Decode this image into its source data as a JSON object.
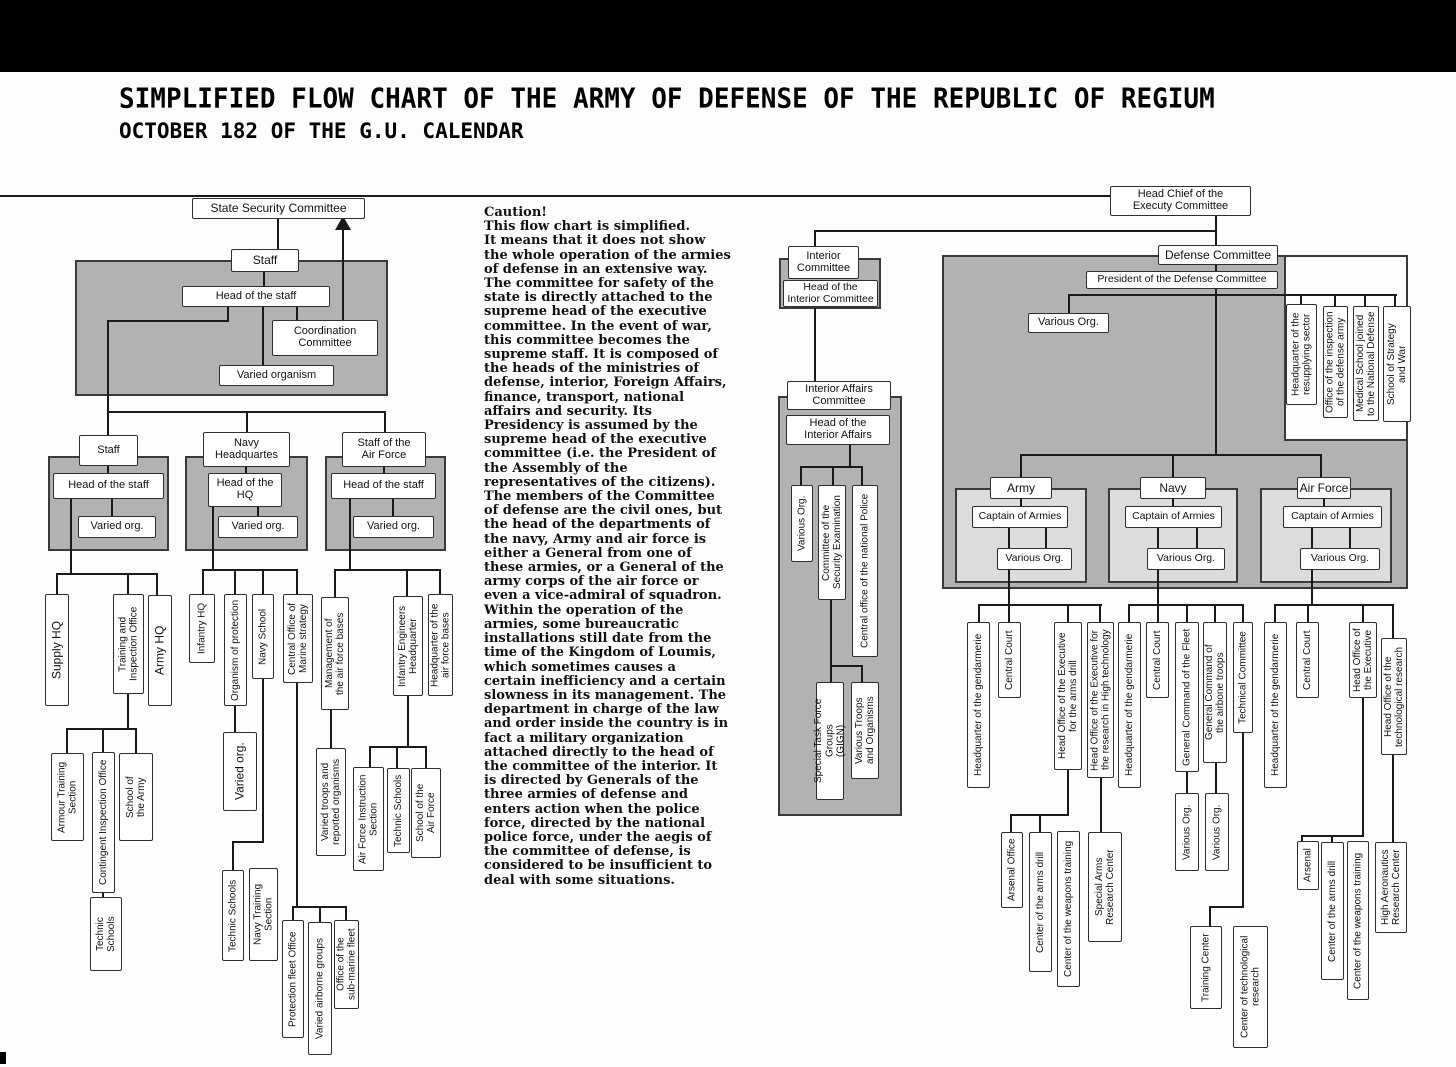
{
  "header": {
    "title": "SIMPLIFIED FLOW CHART OF THE ARMY OF DEFENSE OF THE REPUBLIC OF REGIUM",
    "subtitle": "OCTOBER 182 OF THE G.U. CALENDAR"
  },
  "caution": {
    "heading": "Caution!",
    "body": " This flow chart is simplified.\nIt means that it does not show the whole operation of the armies of defense in an extensive way.\nThe committee for safety of the state is directly attached to the supreme head of the executive committee. In the event of war, this committee becomes the supreme staff. It is composed of the heads of the ministries of defense, interior, Foreign Affairs, finance, transport, national affairs and security. Its Presidency is assumed by the supreme head of the executive committee (i.e. the President of the Assembly of the representatives of the citizens).\n The members of the Committee of defense are the civil ones, but the head of the departments of the navy, Army and air force is either a General from one of these armies, or a General of the army corps of the air force or even a vice-admiral of squadron.\nWithin the operation of the armies, some bureaucratic installations still date from the time of the Kingdom of Loumis, which sometimes causes a certain inefficiency and a certain slowness in its management. The department in charge of the law and order inside the country is in fact a military organization attached directly to the head of the committee of the interior. It is directed by Generals of the three armies of defense and enters action when the police force, directed by the national police force, under the aegis of the committee of defense, is considered to be insufficient to deal with some situations."
  },
  "colors": {
    "panel_gray": "#b2b2b2",
    "panel_light": "#dcdcdc",
    "line_black": "#1a1a1a",
    "box_white": "#ffffff"
  },
  "nodes": {
    "ssc": "State Security Committee",
    "staff_main": "Staff",
    "head_staff_main": "Head of the staff",
    "coordination": "Coordination\nCommittee",
    "varied_organism": "Varied organism",
    "staff_left": "Staff",
    "head_staff_left": "Head of the staff",
    "varied_left": "Varied org.",
    "navy_hq": "Navy\nHeadquartes",
    "head_hq": "Head of the\nHQ",
    "varied_mid": "Varied org.",
    "staff_af": "Staff of the\nAir Force",
    "head_staff_af": "Head of the staff",
    "varied_af": "Varied org.",
    "supply_hq": "Supply HQ",
    "training_inspection": "Training and\nInspection Office",
    "army_hq": "Army HQ",
    "armour_training": "Armour Training\nSection",
    "contingent_inspection": "Contingent Inspection Office",
    "school_army": "School of\nthe Army",
    "technic_schools_1": "Technic\nSchools",
    "infantry_hq": "Infantry HQ",
    "organism_protection": "Organism of protection",
    "navy_school": "Navy School",
    "central_marine": "Central Office of\nMarine strategy",
    "varied_org_m": "Varied org.",
    "technic_schools_2": "Technic Schools",
    "navy_training": "Navy Training\nSection",
    "protection_fleet": "Protection fleet Office",
    "varied_airborne": "Varied airborne groups",
    "office_submarine": "Office of the\nsub-marine fleet",
    "management_afb": "Management of\nthe air force bases",
    "infantry_engineers": "Infantry Engineers\nHeadquarter",
    "hq_afb": "Headquarter of the\nair force bases",
    "varied_troops": "Varied troops and\nreported organisms",
    "af_instruction": "Air Force Instruction\nSection",
    "technic_schools_3": "Technic Schools",
    "school_af": "School of the\nAir Force",
    "interior_committee": "Interior\nCommittee",
    "head_interior_committee": "Head of the\nInterior Committee",
    "interior_affairs": "Interior Affairs\nCommittee",
    "head_interior_affairs": "Head of the\nInterior Affairs",
    "various_org_i": "Various Org.",
    "committee_security": "Committee of the\nSecurity Examination",
    "central_police": "Central office of the national Police",
    "special_task": "Special Task Force Groups\n(GIGN)",
    "various_troops": "Various Troops\nand Organisms",
    "head_chief": "Head Chief of the\nExecuty Committee",
    "defense_committee": "Defense Committee",
    "president_dc": "President of the Defense Committee",
    "various_org_d": "Various Org.",
    "hq_resupplying": "Headquarter of the\nresupplying sector",
    "office_inspection": "Office of the inspection\nof the defense army",
    "medical_school": "Medical School joined\nto the National Defense",
    "school_strategy": "School of Strategy\nand War",
    "army": "Army",
    "captain_a": "Captain of Armies",
    "various_a": "Various Org.",
    "navy": "Navy",
    "captain_n": "Captain of Armies",
    "various_n": "Various Org.",
    "air_force": "Air Force",
    "captain_f": "Captain of Armies",
    "various_f": "Various Org.",
    "gend_a": "Headquarter of the gendarmerie",
    "court_a": "Central Court",
    "ho_arms_drill": "Head Office of the Executive\nfor the arms drill",
    "ho_research_ht": "Head Office of the Executive for\nthe research in High technology",
    "gend_n": "Headquarter of the gendarmerie",
    "court_n": "Central Court",
    "gc_fleet": "General Command of the Fleet",
    "gc_airborne": "General Command of\nthe airbone troops",
    "technical_committee": "Technical Committee",
    "gend_f": "Headquarter of the gendarmerie",
    "court_f": "Central Court",
    "ho_executive": "Head Office of\nthe Executive",
    "ho_tech_research": "Head Office of the\ntechnological research",
    "arsenal_office": "Arsenal Office",
    "center_arms_a": "Center of the arms drill",
    "center_weapons_a": "Center of the weapons training",
    "special_arms": "Special Arms\nResearch Center",
    "various_fleet": "Various Org.",
    "various_airb2": "Various Org.",
    "training_center": "Training Center",
    "center_tech_research": "Center of technological\nresearch",
    "arsenal_f": "Arsenal",
    "center_arms_f": "Center of the arms drill",
    "center_weapons_f": "Center of the weapons training",
    "high_aeronautics": "High Aeronautics\nResearch Center"
  }
}
